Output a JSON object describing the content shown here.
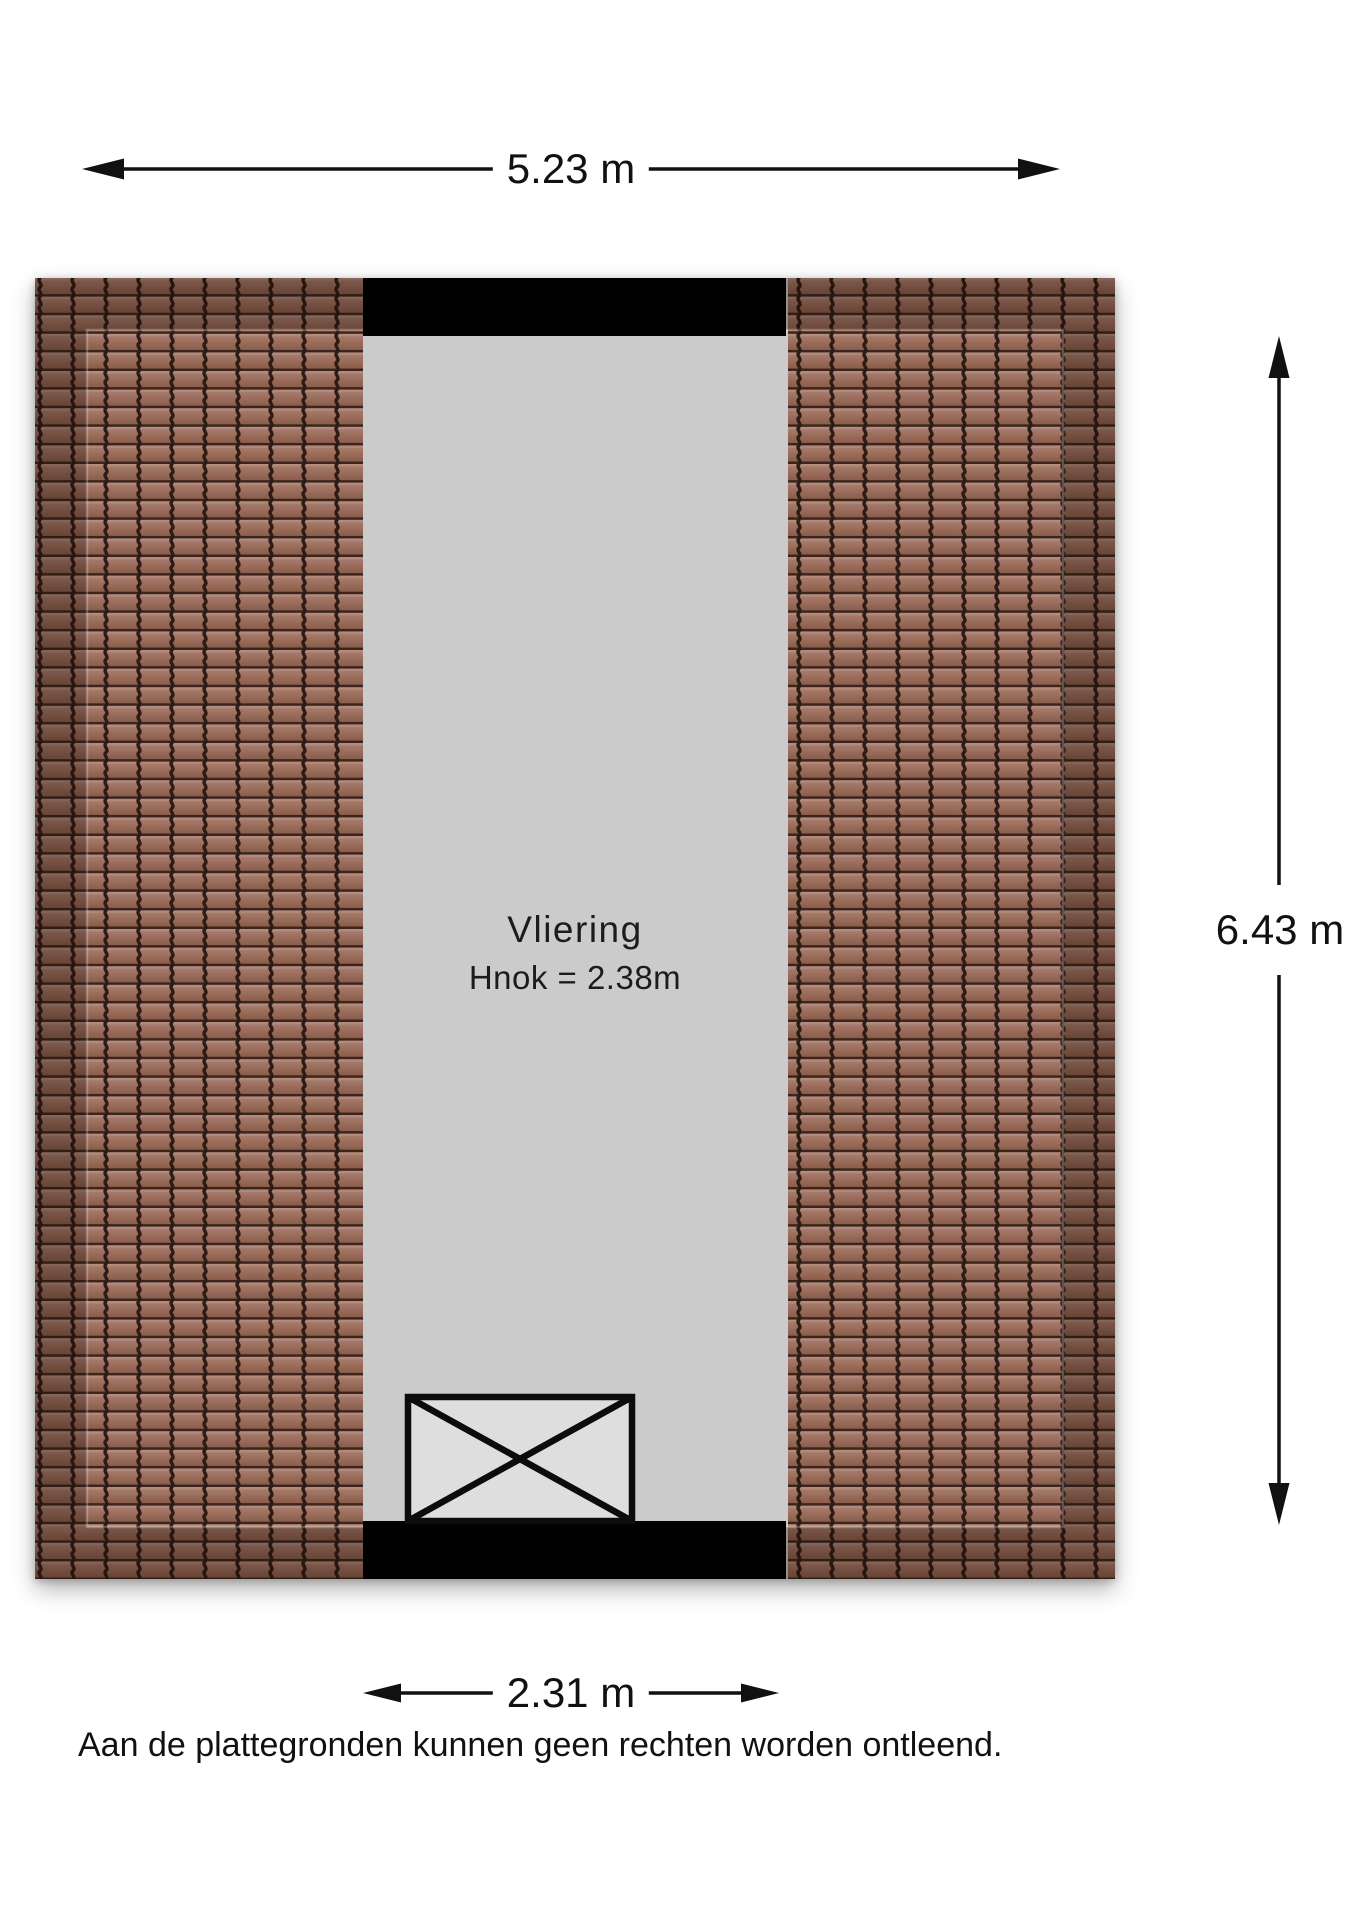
{
  "floorplan": {
    "room_label": "Vliering",
    "room_height_label": "Hnok = 2.38m",
    "colors": {
      "tile_light": "#a87c6b",
      "tile_base": "#976958",
      "tile_dark": "#8a5c4a",
      "tile_groove": "#2d1b15",
      "floor": "#cbcbcb",
      "wall": "#020202",
      "stair_fill": "#dedede",
      "dimension_text": "#111111"
    }
  },
  "dimensions": {
    "top": "5.23 m",
    "right": "6.43 m",
    "bottom": "2.31 m"
  },
  "disclaimer": "Aan de plattegronden kunnen geen rechten worden ontleend."
}
